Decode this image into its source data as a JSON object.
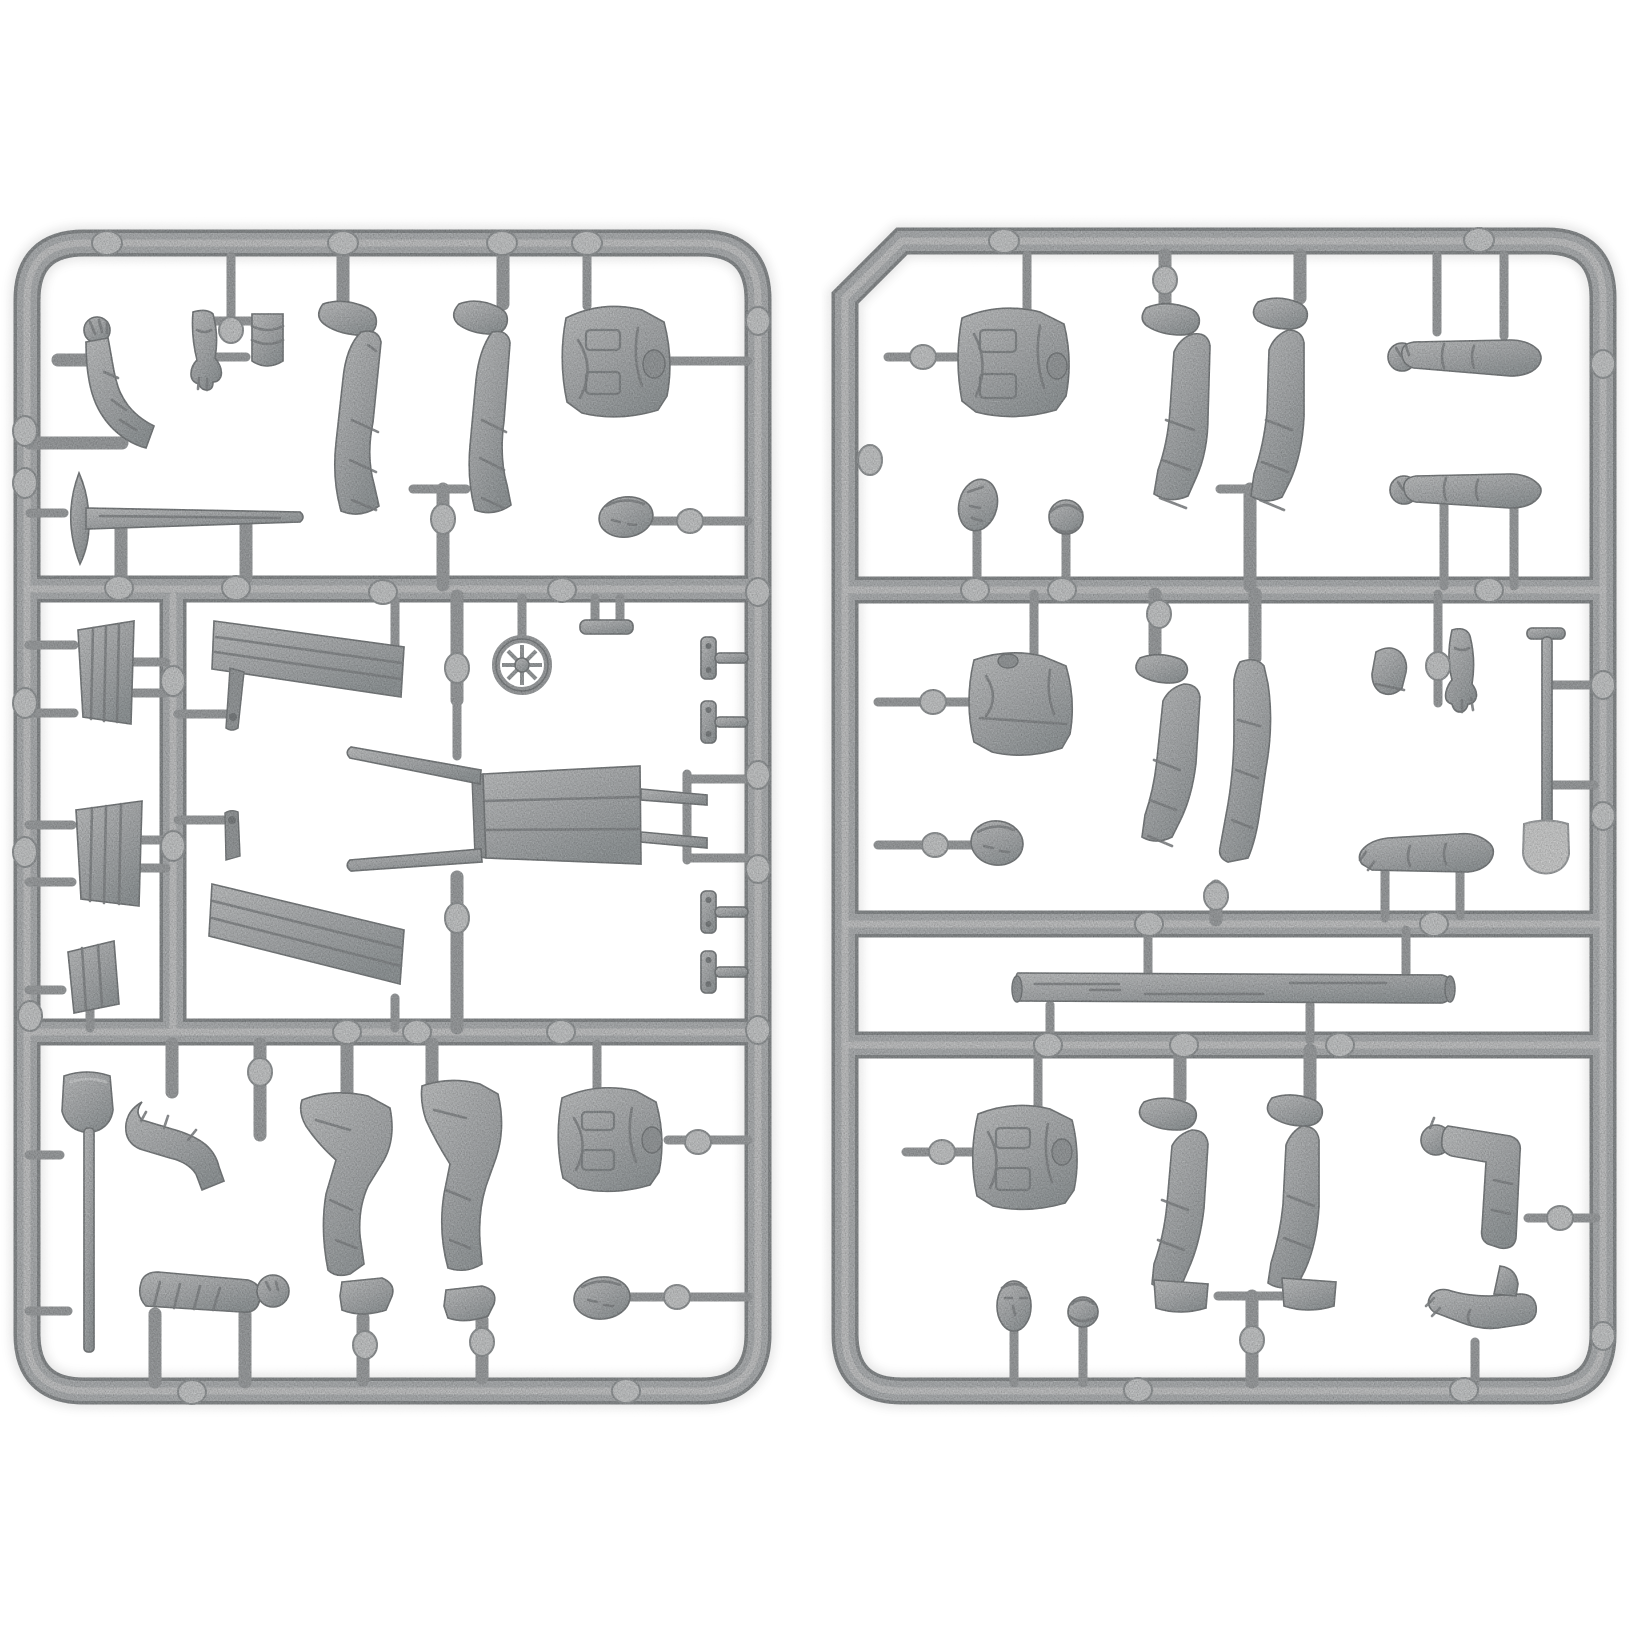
{
  "meta": {
    "alt": "Two light-gray plastic model kit sprues with 1/35-scale figure parts: legs, jackets, torsos, heads, arms, hands, shovels, a pickaxe, a wheelbarrow with spoked wheel, wooden panels, benches and a log, all attached to rectangular runner frames with round ejector marks."
  },
  "colors": {
    "background": "#ffffff",
    "plastic_base": "#c6c9cb",
    "plastic_mid": "#b9bcbe",
    "plastic_highlight": "#e0e2e3",
    "plastic_shadow": "#9da1a3",
    "outline": "#8d9193",
    "ejector_mark": "#e0e2e3",
    "ejector_ring": "#a8acae",
    "shovel_blade": "#e9eaea",
    "crease": "#969a9c",
    "hole": "#8e9294"
  },
  "canvas": {
    "width": 1632,
    "height": 1632
  },
  "sprues": [
    {
      "id": "left",
      "label": "Sprue A (figures, wheelbarrow and tools)",
      "frame": {
        "x": 14,
        "y": 230,
        "w": 758,
        "h": 1175
      },
      "parts": [
        {
          "name": "bent-arm-raised",
          "label": "Bent arm with raised fist",
          "x": 55,
          "y": 305,
          "w": 105,
          "h": 150
        },
        {
          "name": "pickaxe",
          "label": "Pickaxe",
          "x": 28,
          "y": 468,
          "w": 280,
          "h": 100
        },
        {
          "name": "open-hand-arm",
          "label": "Forearm with open hand",
          "x": 185,
          "y": 300,
          "w": 40,
          "h": 100
        },
        {
          "name": "rolled-cuff",
          "label": "Rolled sleeve cuff",
          "x": 248,
          "y": 308,
          "w": 40,
          "h": 65
        },
        {
          "name": "leg-straight-1",
          "label": "Trouser leg with boot",
          "x": 316,
          "y": 298,
          "w": 85,
          "h": 232
        },
        {
          "name": "leg-straight-2",
          "label": "Trouser leg with boot",
          "x": 450,
          "y": 298,
          "w": 80,
          "h": 230
        },
        {
          "name": "jacket-torso-1",
          "label": "Jacket torso",
          "x": 556,
          "y": 304,
          "w": 118,
          "h": 104
        },
        {
          "name": "head-1",
          "label": "Head",
          "x": 598,
          "y": 495,
          "w": 58,
          "h": 44
        },
        {
          "name": "wood-panel-1",
          "label": "Wooden panel",
          "x": 74,
          "y": 618,
          "w": 64,
          "h": 108
        },
        {
          "name": "wood-panel-2",
          "label": "Wooden panel",
          "x": 72,
          "y": 798,
          "w": 72,
          "h": 110
        },
        {
          "name": "small-board",
          "label": "Small board",
          "x": 64,
          "y": 938,
          "w": 56,
          "h": 76
        },
        {
          "name": "bench-plank-1",
          "label": "Bench plank",
          "x": 210,
          "y": 616,
          "w": 198,
          "h": 84
        },
        {
          "name": "bench-leg-1",
          "label": "Bench support",
          "x": 224,
          "y": 666,
          "w": 26,
          "h": 64
        },
        {
          "name": "bench-plank-2",
          "label": "Bench plank",
          "x": 206,
          "y": 866,
          "w": 200,
          "h": 122
        },
        {
          "name": "bench-leg-2",
          "label": "Bench support",
          "x": 220,
          "y": 808,
          "w": 26,
          "h": 58
        },
        {
          "name": "spoked-wheel",
          "label": "Spoked wheel",
          "x": 492,
          "y": 634,
          "w": 62,
          "h": 62
        },
        {
          "name": "axle-bar",
          "label": "Axle bar",
          "x": 576,
          "y": 616,
          "w": 60,
          "h": 22
        },
        {
          "name": "wheelbarrow-body",
          "label": "Wheelbarrow tray with handles",
          "x": 346,
          "y": 742,
          "w": 364,
          "h": 140
        },
        {
          "name": "t-bracket-1",
          "label": "Hinge bracket",
          "x": 699,
          "y": 636,
          "w": 50,
          "h": 44
        },
        {
          "name": "t-bracket-2",
          "label": "Hinge bracket",
          "x": 699,
          "y": 700,
          "w": 50,
          "h": 44
        },
        {
          "name": "t-bracket-3",
          "label": "Hinge bracket",
          "x": 699,
          "y": 890,
          "w": 50,
          "h": 44
        },
        {
          "name": "t-bracket-4",
          "label": "Hinge bracket",
          "x": 699,
          "y": 950,
          "w": 50,
          "h": 44
        },
        {
          "name": "shovel",
          "label": "Shovel",
          "x": 60,
          "y": 1070,
          "w": 56,
          "h": 284
        },
        {
          "name": "bent-arm-elbow",
          "label": "Arm bent at elbow",
          "x": 136,
          "y": 1094,
          "w": 116,
          "h": 68
        },
        {
          "name": "rolled-sleeve-arm",
          "label": "Sleeved arm with fist",
          "x": 136,
          "y": 1268,
          "w": 158,
          "h": 52
        },
        {
          "name": "leg-bent-1",
          "label": "Bent leg with boot",
          "x": 294,
          "y": 1092,
          "w": 104,
          "h": 232
        },
        {
          "name": "leg-bent-2",
          "label": "Bent leg with boot",
          "x": 416,
          "y": 1080,
          "w": 92,
          "h": 244
        },
        {
          "name": "jacket-torso-2",
          "label": "Jacket torso",
          "x": 554,
          "y": 1090,
          "w": 118,
          "h": 92
        },
        {
          "name": "head-2",
          "label": "Head",
          "x": 570,
          "y": 1276,
          "w": 64,
          "h": 46
        }
      ]
    },
    {
      "id": "right",
      "label": "Sprue B (figures, log and trench shovel)",
      "frame": {
        "x": 845,
        "y": 226,
        "w": 772,
        "h": 1178
      },
      "parts": [
        {
          "name": "jacket-torso-3",
          "label": "Jacket torso",
          "x": 954,
          "y": 308,
          "w": 118,
          "h": 98
        },
        {
          "name": "head-3",
          "label": "Head",
          "x": 956,
          "y": 476,
          "w": 44,
          "h": 58
        },
        {
          "name": "cap-head-1",
          "label": "Head in cap",
          "x": 1047,
          "y": 498,
          "w": 38,
          "h": 40
        },
        {
          "name": "leg-straight-3",
          "label": "Trouser leg with boot",
          "x": 1136,
          "y": 300,
          "w": 88,
          "h": 222
        },
        {
          "name": "leg-straight-4",
          "label": "Trouser leg with boot",
          "x": 1248,
          "y": 296,
          "w": 84,
          "h": 238
        },
        {
          "name": "arm-straight-1",
          "label": "Sleeved arm with fist",
          "x": 1386,
          "y": 334,
          "w": 158,
          "h": 48
        },
        {
          "name": "arm-straight-2",
          "label": "Sleeved arm with fist",
          "x": 1388,
          "y": 464,
          "w": 158,
          "h": 48
        },
        {
          "name": "tunic-torso",
          "label": "Tunic torso",
          "x": 964,
          "y": 650,
          "w": 112,
          "h": 106
        },
        {
          "name": "head-4",
          "label": "Head",
          "x": 968,
          "y": 818,
          "w": 58,
          "h": 48
        },
        {
          "name": "leg-straight-5",
          "label": "Trouser leg with boot",
          "x": 1132,
          "y": 650,
          "w": 76,
          "h": 224
        },
        {
          "name": "leg-straight-6",
          "label": "Trouser leg",
          "x": 1220,
          "y": 656,
          "w": 60,
          "h": 236
        },
        {
          "name": "boot-part",
          "label": "Boot",
          "x": 1368,
          "y": 644,
          "w": 48,
          "h": 60
        },
        {
          "name": "open-hand-forearm",
          "label": "Forearm with open hand",
          "x": 1444,
          "y": 622,
          "w": 60,
          "h": 94
        },
        {
          "name": "trench-shovel",
          "label": "Trench shovel",
          "x": 1519,
          "y": 624,
          "w": 54,
          "h": 250
        },
        {
          "name": "bent-arm-rest",
          "label": "Resting bent arm",
          "x": 1356,
          "y": 828,
          "w": 144,
          "h": 46
        },
        {
          "name": "log",
          "label": "Log",
          "x": 1009,
          "y": 970,
          "w": 448,
          "h": 38
        },
        {
          "name": "jacket-torso-4",
          "label": "Jacket torso",
          "x": 970,
          "y": 1106,
          "w": 110,
          "h": 98
        },
        {
          "name": "leg-straight-7",
          "label": "Trouser leg with boot",
          "x": 1134,
          "y": 1092,
          "w": 84,
          "h": 222
        },
        {
          "name": "leg-straight-8",
          "label": "Trouser leg with boot",
          "x": 1262,
          "y": 1090,
          "w": 92,
          "h": 224
        },
        {
          "name": "head-5",
          "label": "Head",
          "x": 993,
          "y": 1278,
          "w": 44,
          "h": 54
        },
        {
          "name": "cap-head-2",
          "label": "Head in cap",
          "x": 1064,
          "y": 1292,
          "w": 38,
          "h": 42
        },
        {
          "name": "thumbs-up-arm",
          "label": "Arm with fist",
          "x": 1418,
          "y": 1098,
          "w": 116,
          "h": 154
        },
        {
          "name": "folded-arm",
          "label": "Folded arm with hand",
          "x": 1422,
          "y": 1256,
          "w": 112,
          "h": 92
        }
      ]
    }
  ]
}
